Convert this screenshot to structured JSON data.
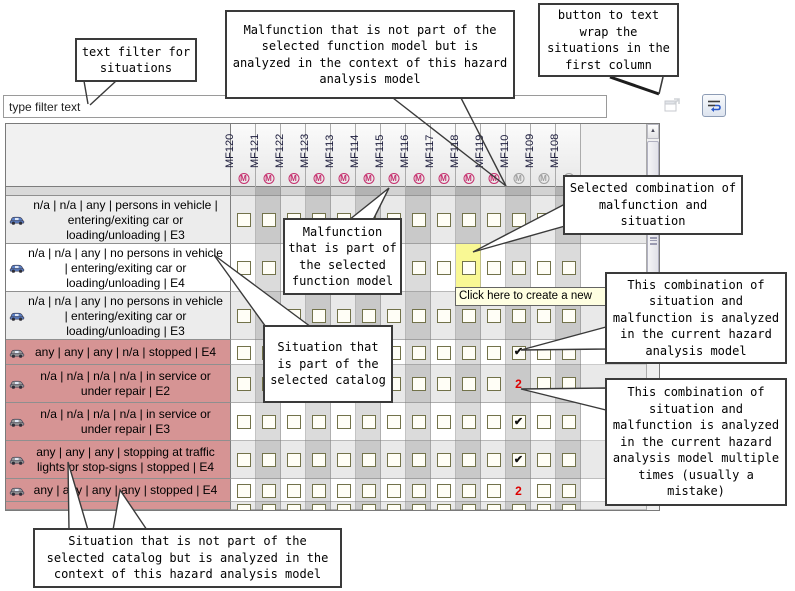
{
  "filter": {
    "value": "type filter text"
  },
  "toolbar": {
    "clear_filter_icon": "clear-filter-icon",
    "wrap_icon": "text-wrap-icon"
  },
  "tooltip": {
    "text": "Click here to create a new"
  },
  "callouts": {
    "filter": {
      "text": "text filter for situations"
    },
    "malfunction_external": {
      "text": "Malfunction that is not part of the selected function model but is analyzed in the context of this hazard analysis model"
    },
    "wrap_button": {
      "text": "button to text wrap the situations in the first column"
    },
    "selected_combination": {
      "text": "Selected combination of malfunction and situation"
    },
    "malfunction_internal": {
      "text": "Malfunction that is part of the selected function model"
    },
    "situation_catalog": {
      "text": "Situation that is part of the selected catalog"
    },
    "analyzed_once": {
      "text": "This combination of situation and malfunction is analyzed in the current hazard analysis model"
    },
    "analyzed_multiple": {
      "text": "This combination of situation and malfunction is analyzed in the current hazard analysis model multiple times (usually a mistake)"
    },
    "situation_external": {
      "text": "Situation that is not part of the selected catalog but is analyzed in the context of this hazard analysis model"
    }
  },
  "matrix": {
    "columns": [
      {
        "id": "MF120",
        "in_model": true
      },
      {
        "id": "MF121",
        "in_model": true
      },
      {
        "id": "MF122",
        "in_model": true
      },
      {
        "id": "MF123",
        "in_model": true
      },
      {
        "id": "MF113",
        "in_model": true
      },
      {
        "id": "MF114",
        "in_model": true
      },
      {
        "id": "MF115",
        "in_model": true
      },
      {
        "id": "MF116",
        "in_model": true
      },
      {
        "id": "MF117",
        "in_model": true
      },
      {
        "id": "MF118",
        "in_model": true
      },
      {
        "id": "MF119",
        "in_model": true
      },
      {
        "id": "MF110",
        "in_model": false
      },
      {
        "id": "MF109",
        "in_model": false
      },
      {
        "id": "MF108",
        "in_model": false
      }
    ],
    "rows": [
      {
        "n": 1,
        "label": "n/a | n/a | any | persons in vehicle | entering/exiting car or loading/unloading | E3",
        "in_catalog": true
      },
      {
        "n": 2,
        "label": "n/a | n/a | any | no persons in vehicle | entering/exiting car or loading/unloading | E4",
        "in_catalog": true
      },
      {
        "n": 3,
        "label": "n/a | n/a | any | no persons in vehicle | entering/exiting car or loading/unloading | E3",
        "in_catalog": true
      },
      {
        "n": 4,
        "label": "any | any | any | n/a | stopped | E4",
        "in_catalog": false
      },
      {
        "n": 5,
        "label": "n/a | n/a | n/a | n/a | in service or under repair | E2",
        "in_catalog": false
      },
      {
        "n": 6,
        "label": "n/a | n/a | n/a | n/a | in service or under repair | E3",
        "in_catalog": false
      },
      {
        "n": 7,
        "label": "any | any | any | stopping at traffic lights or stop-signs | stopped | E4",
        "in_catalog": false
      },
      {
        "n": 8,
        "label": "any | any | any | any | stopped | E4",
        "in_catalog": false
      }
    ],
    "marks": [
      {
        "row": 4,
        "col": "MF110",
        "mark": "check"
      },
      {
        "row": 5,
        "col": "MF110",
        "mark": "2"
      },
      {
        "row": 6,
        "col": "MF110",
        "mark": "check"
      },
      {
        "row": 7,
        "col": "MF110",
        "mark": "check"
      },
      {
        "row": 8,
        "col": "MF110",
        "mark": "2"
      }
    ],
    "selected": {
      "row": 2,
      "col": "MF118"
    },
    "icons": {
      "malfunction_badge": "M",
      "checkmark": "✔",
      "scroll_up_arrow": "▲",
      "situation_icon": "car-icon"
    },
    "colors": {
      "in_model_icon": "#c62f6e",
      "external_icon": "#a0a0a0",
      "external_row": "#d69494",
      "selected_cell": "#f9f894",
      "duplicate_count": "#dd0000",
      "catalog_car": "#5b7fc4",
      "external_car": "#9a9a9a"
    }
  }
}
